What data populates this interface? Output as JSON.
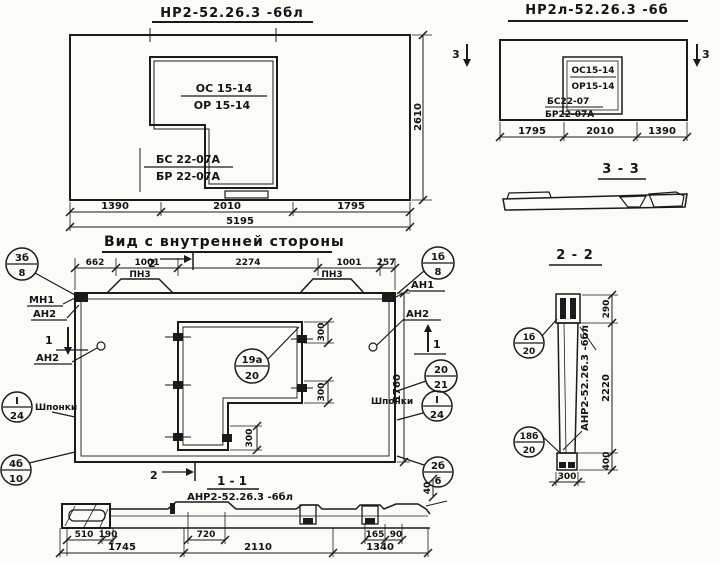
{
  "top_left": {
    "title": "НР2-52.26.3 -6бл",
    "mark_os": "ОС 15-14",
    "mark_or": "ОР 15-14",
    "mark_bs": "БС 22-07А",
    "mark_br": "БР 22-07А",
    "dims": [
      "1390",
      "2010",
      "1795"
    ],
    "total": "5195",
    "height": "2610"
  },
  "top_right": {
    "title": "НР2л-52.26.3 -6б",
    "mark_os": "ОС15-14",
    "mark_or": "ОР15-14",
    "mark_bs": "БС22-07",
    "mark_br": "БР22-07А",
    "dims": [
      "1795",
      "2010",
      "1390"
    ],
    "section_no": "3"
  },
  "section_3_3": {
    "title": "3 - 3"
  },
  "inner_view": {
    "title": "Вид с внутренней стороны",
    "top_dims": [
      "662",
      "1001",
      "2274",
      "1001",
      "257"
    ],
    "height": "1760",
    "dim_300": "300",
    "loop_label": "ПН3",
    "label_mn1": "МН1",
    "label_an2": "АН2",
    "label_an1": "АН1",
    "label_shponki": "Шпонки",
    "marker_1": "1",
    "marker_2": "2",
    "callouts": {
      "c3b8": {
        "top": "3б",
        "bottom": "8"
      },
      "c1b8": {
        "top": "1б",
        "bottom": "8"
      },
      "c19a20": {
        "top": "19а",
        "bottom": "20"
      },
      "c2021": {
        "top": "20",
        "bottom": "21"
      },
      "cI24": {
        "top": "I",
        "bottom": "24"
      },
      "c4b10": {
        "top": "4б",
        "bottom": "10"
      },
      "c2b6": {
        "top": "2б",
        "bottom": "6"
      }
    }
  },
  "section_1_1": {
    "title": "1 - 1",
    "label": "АНР2-52.26.3 -6бл",
    "dims_row1": [
      "510",
      "190",
      "720",
      "165",
      "90"
    ],
    "dims_row2": [
      "1745",
      "2110",
      "1340"
    ],
    "dim_40": "40"
  },
  "section_2_2": {
    "title": "2 - 2",
    "label": "АНР2-52.26.3 -6бл",
    "dim_290": "290",
    "dim_2220": "2220",
    "dim_400": "400",
    "dim_300": "300",
    "callouts": {
      "c1b20": {
        "top": "1б",
        "bottom": "20"
      },
      "c18b20": {
        "top": "18б",
        "bottom": "20"
      }
    }
  }
}
